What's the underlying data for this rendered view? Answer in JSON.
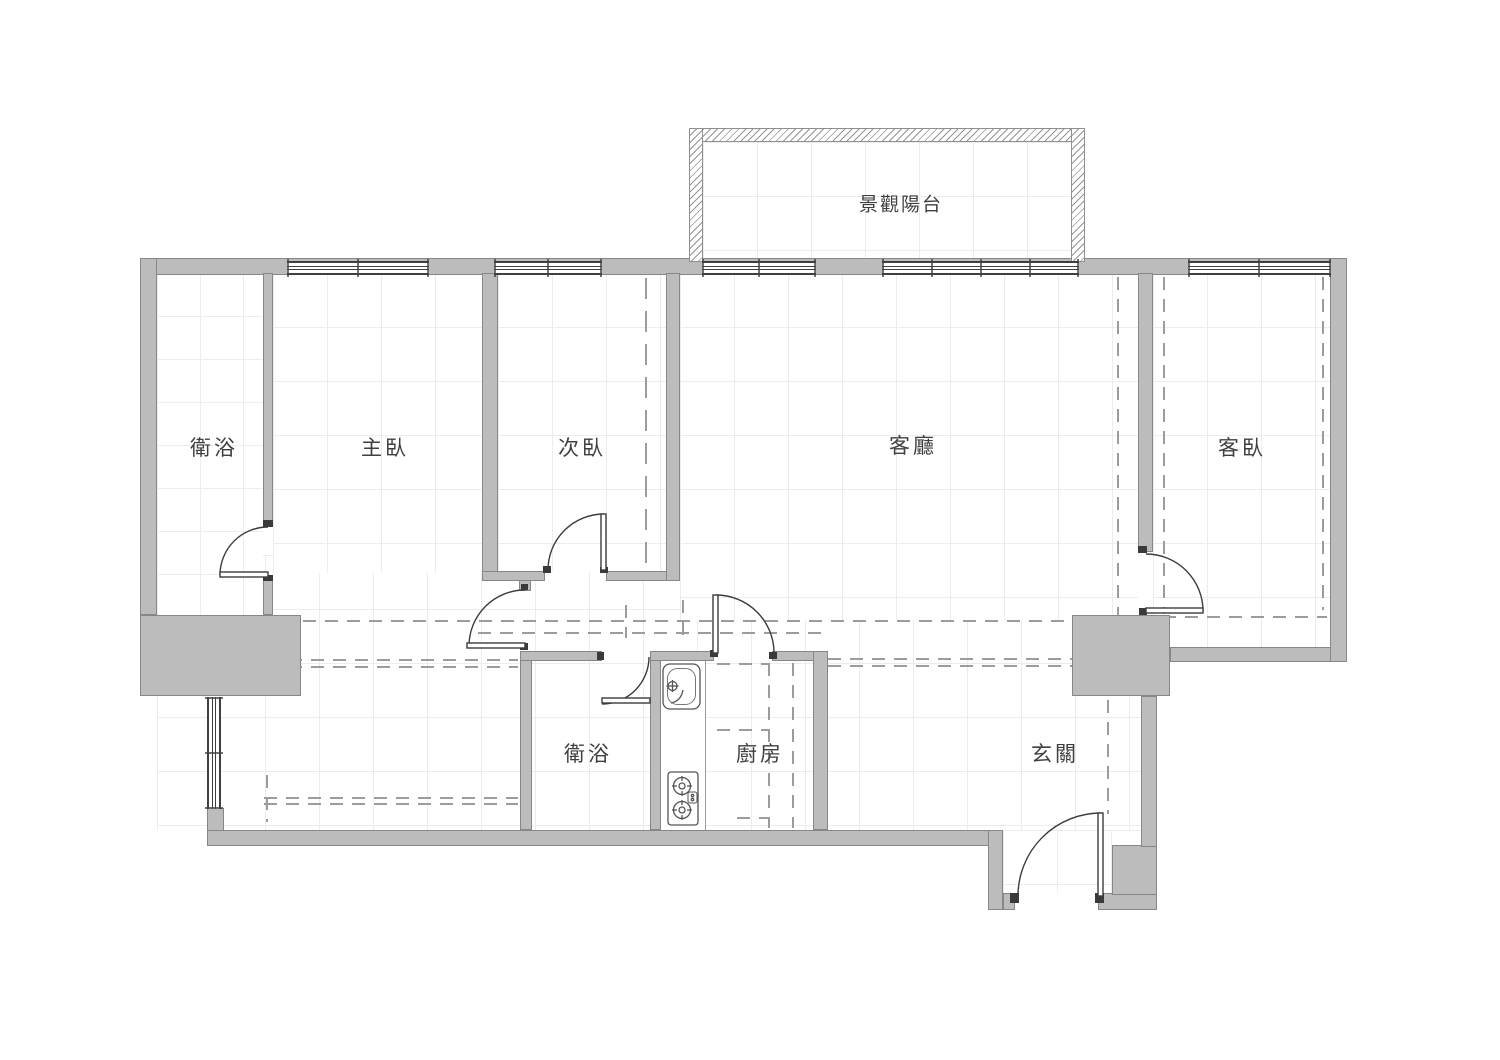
{
  "canvas": {
    "width": 1500,
    "height": 1060,
    "background": "#ffffff"
  },
  "plan": {
    "type": "apartment-floor-plan",
    "rooms": [
      {
        "id": "balcony",
        "label": "景觀陽台"
      },
      {
        "id": "bath-upper",
        "label": "衛浴"
      },
      {
        "id": "master-bedroom",
        "label": "主臥"
      },
      {
        "id": "second-bedroom",
        "label": "次臥"
      },
      {
        "id": "living-room",
        "label": "客廳"
      },
      {
        "id": "guest-bedroom",
        "label": "客臥"
      },
      {
        "id": "bath-lower",
        "label": "衛浴"
      },
      {
        "id": "kitchen",
        "label": "廚房"
      },
      {
        "id": "entry",
        "label": "玄關"
      }
    ],
    "fixtures": [
      {
        "name": "kitchen-sink"
      },
      {
        "name": "gas-stove"
      }
    ],
    "colors": {
      "wall_fill": "#bcbcbc",
      "wall_edge": "#878787",
      "line": "#3c3c3c",
      "dashed": "#9c9c9c",
      "grid": "#ececec",
      "hatch": "#949494",
      "text": "#3f3f3f"
    }
  }
}
